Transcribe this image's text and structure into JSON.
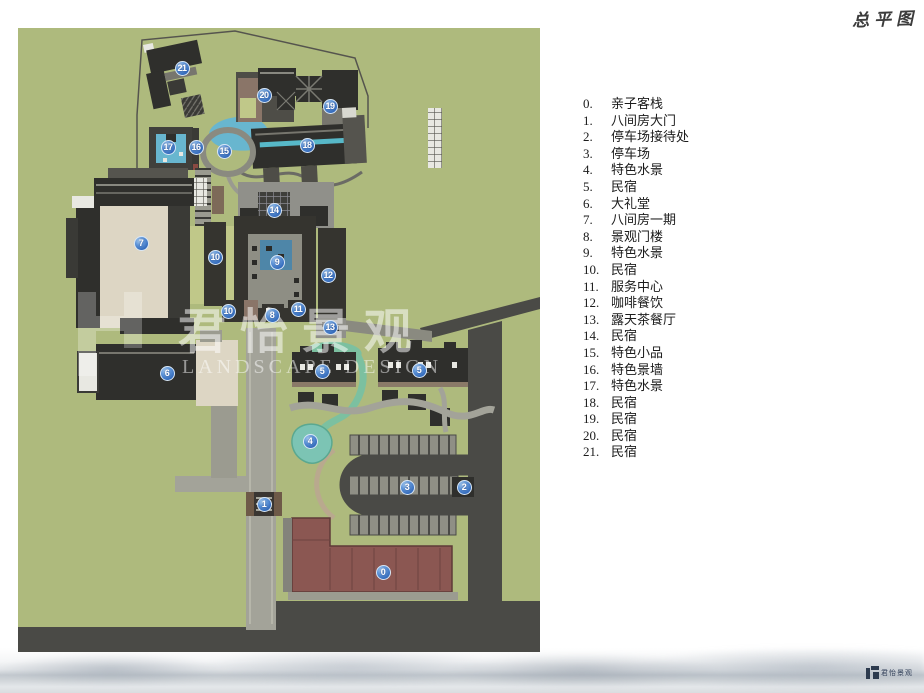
{
  "title": {
    "text": "总平图"
  },
  "watermark": {
    "cn": "君怡景观",
    "en": "LANDSCAPE DESIGN"
  },
  "footer_logo": {
    "text": "君怡景观"
  },
  "palette": {
    "site_green": "#aeba7d",
    "road_dark": "#4a4a46",
    "road_light": "#a3a399",
    "building_dark": "#2f2f2c",
    "courtyard_beige": "#ddd6c4",
    "water_blue": "#68b6cf",
    "water_teal": "#7cc4b4",
    "inn_red": "#8b5752",
    "marker_blue": "#2f66b8"
  },
  "legend": {
    "items": [
      {
        "num": "0.",
        "label": "亲子客栈"
      },
      {
        "num": "1.",
        "label": "八间房大门"
      },
      {
        "num": "2.",
        "label": "停车场接待处"
      },
      {
        "num": "3.",
        "label": "停车场"
      },
      {
        "num": "4.",
        "label": "特色水景"
      },
      {
        "num": "5.",
        "label": "民宿"
      },
      {
        "num": "6.",
        "label": "大礼堂"
      },
      {
        "num": "7.",
        "label": "八间房一期"
      },
      {
        "num": "8.",
        "label": "景观门楼"
      },
      {
        "num": "9.",
        "label": "特色水景"
      },
      {
        "num": "10.",
        "label": "民宿"
      },
      {
        "num": "11.",
        "label": "服务中心"
      },
      {
        "num": "12.",
        "label": "咖啡餐饮"
      },
      {
        "num": "13.",
        "label": "露天茶餐厅"
      },
      {
        "num": "14.",
        "label": "民宿"
      },
      {
        "num": "15.",
        "label": "特色小品"
      },
      {
        "num": "16.",
        "label": "特色景墙"
      },
      {
        "num": "17.",
        "label": "特色水景"
      },
      {
        "num": "18.",
        "label": "民宿"
      },
      {
        "num": "19.",
        "label": "民宿"
      },
      {
        "num": "20.",
        "label": "民宿"
      },
      {
        "num": "21.",
        "label": "民宿"
      }
    ]
  },
  "plan": {
    "markers": [
      {
        "n": "0",
        "x": 383,
        "y": 572
      },
      {
        "n": "1",
        "x": 264,
        "y": 504
      },
      {
        "n": "2",
        "x": 464,
        "y": 487
      },
      {
        "n": "3",
        "x": 407,
        "y": 487
      },
      {
        "n": "4",
        "x": 310,
        "y": 441
      },
      {
        "n": "5",
        "x": 322,
        "y": 371
      },
      {
        "n": "5",
        "x": 419,
        "y": 370
      },
      {
        "n": "6",
        "x": 167,
        "y": 373
      },
      {
        "n": "7",
        "x": 141,
        "y": 243
      },
      {
        "n": "8",
        "x": 272,
        "y": 315
      },
      {
        "n": "9",
        "x": 277,
        "y": 262
      },
      {
        "n": "10",
        "x": 215,
        "y": 257
      },
      {
        "n": "10",
        "x": 228,
        "y": 311
      },
      {
        "n": "11",
        "x": 298,
        "y": 309
      },
      {
        "n": "12",
        "x": 328,
        "y": 275
      },
      {
        "n": "13",
        "x": 330,
        "y": 327
      },
      {
        "n": "14",
        "x": 274,
        "y": 210
      },
      {
        "n": "15",
        "x": 224,
        "y": 151
      },
      {
        "n": "16",
        "x": 196,
        "y": 147
      },
      {
        "n": "17",
        "x": 168,
        "y": 147
      },
      {
        "n": "18",
        "x": 307,
        "y": 145
      },
      {
        "n": "19",
        "x": 330,
        "y": 106
      },
      {
        "n": "20",
        "x": 264,
        "y": 95
      },
      {
        "n": "21",
        "x": 182,
        "y": 68
      }
    ]
  }
}
